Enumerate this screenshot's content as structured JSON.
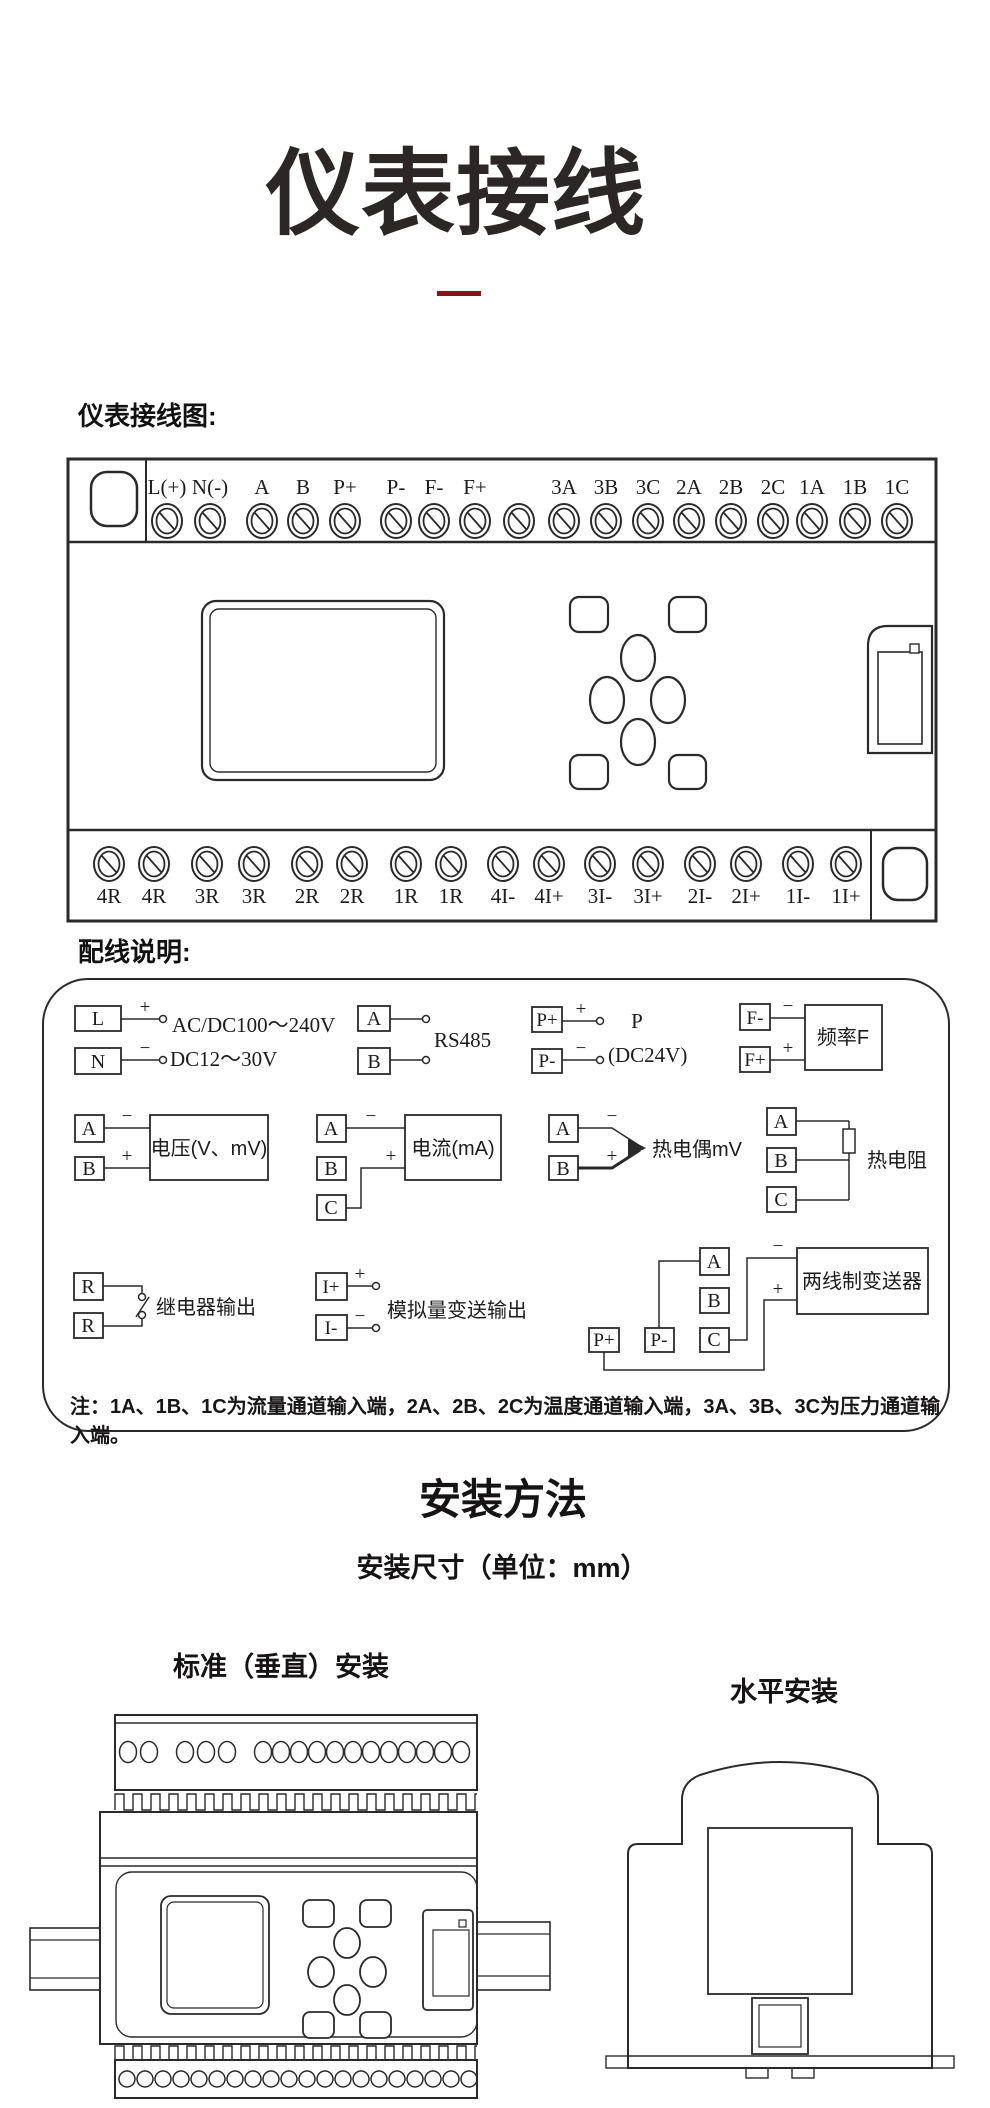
{
  "header": {
    "title": "仪表接线"
  },
  "wiring": {
    "section_label": "仪表接线图:",
    "top_terminals": [
      "L(+)",
      "N(-)",
      "A",
      "B",
      "P+",
      "P-",
      "F-",
      "F+",
      "3A",
      "3B",
      "3C",
      "2A",
      "2B",
      "2C",
      "1A",
      "1B",
      "1C"
    ],
    "bottom_terminals": [
      "4R",
      "4R",
      "3R",
      "3R",
      "2R",
      "2R",
      "1R",
      "1R",
      "4I-",
      "4I+",
      "3I-",
      "3I+",
      "2I-",
      "2I+",
      "1I-",
      "1I+"
    ]
  },
  "legend": {
    "section_label": "配线说明:",
    "power": {
      "t1": "L",
      "t2": "N",
      "plus": "+",
      "minus": "−",
      "line1": "AC/DC100～240V",
      "line2": "DC12～30V"
    },
    "rs485": {
      "t1": "A",
      "t2": "B",
      "label": "RS485"
    },
    "dc24": {
      "t1": "P+",
      "t2": "P-",
      "plus": "+",
      "minus": "−",
      "line1": "P",
      "line2": "(DC24V)"
    },
    "freq": {
      "t1": "F-",
      "t2": "F+",
      "minus": "−",
      "plus": "+",
      "box": "频率F"
    },
    "voltage": {
      "t1": "A",
      "t2": "B",
      "minus": "−",
      "plus": "+",
      "box": "电压(V、mV)"
    },
    "current": {
      "t1": "A",
      "t2": "B",
      "t3": "C",
      "minus": "−",
      "plus": "+",
      "box": "电流(mA)"
    },
    "thermocouple": {
      "t1": "A",
      "t2": "B",
      "minus": "−",
      "plus": "+",
      "label": "热电偶mV"
    },
    "rtd": {
      "t1": "A",
      "t2": "B",
      "t3": "C",
      "label": "热电阻"
    },
    "relay": {
      "t1": "R",
      "t2": "R",
      "label": "继电器输出"
    },
    "analog_out": {
      "t1": "I+",
      "t2": "I-",
      "plus": "+",
      "minus": "−",
      "label": "模拟量变送输出"
    },
    "transmitter": {
      "t1": "A",
      "t2": "B",
      "t3": "C",
      "t4": "P+",
      "t5": "P-",
      "minus": "−",
      "plus": "+",
      "box": "两线制变送器"
    },
    "note": "注：1A、1B、1C为流量通道输入端，2A、2B、2C为温度通道输入端，3A、3B、3C为压力通道输入端。"
  },
  "install": {
    "title": "安装方法",
    "subtitle": "安装尺寸（单位：mm）",
    "vertical_label": "标准（垂直）安装",
    "horizontal_label": "水平安装"
  }
}
